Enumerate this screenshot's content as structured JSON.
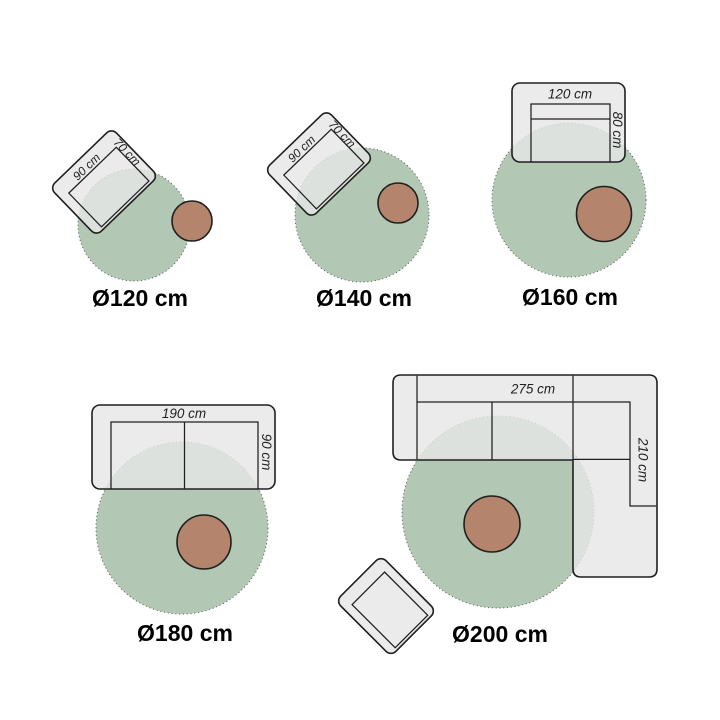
{
  "colors": {
    "background": "#ffffff",
    "rug_fill": "#b2c8b4",
    "rug_edge": "#5c6e5c",
    "table_fill": "#b5846c",
    "furniture_fill": "rgba(231,231,231,0.82)",
    "line": "#1f1f1f",
    "label": "#1f1f1f",
    "caption": "#000000"
  },
  "diagrams": [
    {
      "caption": "Ø120 cm",
      "furniture": "armchair",
      "width_label": "90 cm",
      "depth_label": "70 cm"
    },
    {
      "caption": "Ø140 cm",
      "furniture": "armchair",
      "width_label": "90 cm",
      "depth_label": "70 cm"
    },
    {
      "caption": "Ø160 cm",
      "furniture": "loveseat",
      "width_label": "120 cm",
      "depth_label": "80 cm"
    },
    {
      "caption": "Ø180 cm",
      "furniture": "sofa",
      "width_label": "190 cm",
      "depth_label": "90 cm"
    },
    {
      "caption": "Ø200 cm",
      "furniture": "corner-sofa",
      "width_label": "275 cm",
      "depth_label": "210 cm"
    }
  ]
}
